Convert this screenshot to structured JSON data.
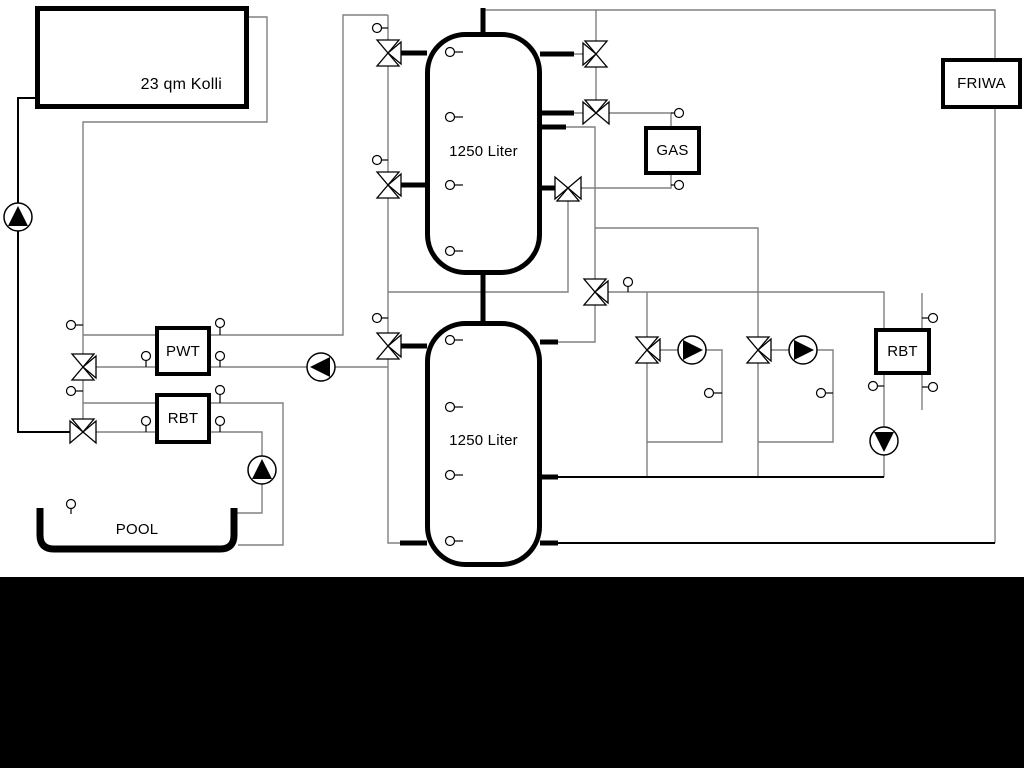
{
  "labels": {
    "collector": "23 qm Kolli",
    "tank_top": "1250 Liter",
    "tank_bottom": "1250 Liter",
    "gas": "GAS",
    "friwa": "FRIWA",
    "pwt": "PWT",
    "rbt_left": "RBT",
    "rbt_right": "RBT",
    "pool": "POOL"
  },
  "colors": {
    "background": "#ffffff",
    "pipe_gray": "#808080",
    "pipe_black": "#000000",
    "component_outline": "#000000",
    "bottom_bar": "#000000"
  }
}
